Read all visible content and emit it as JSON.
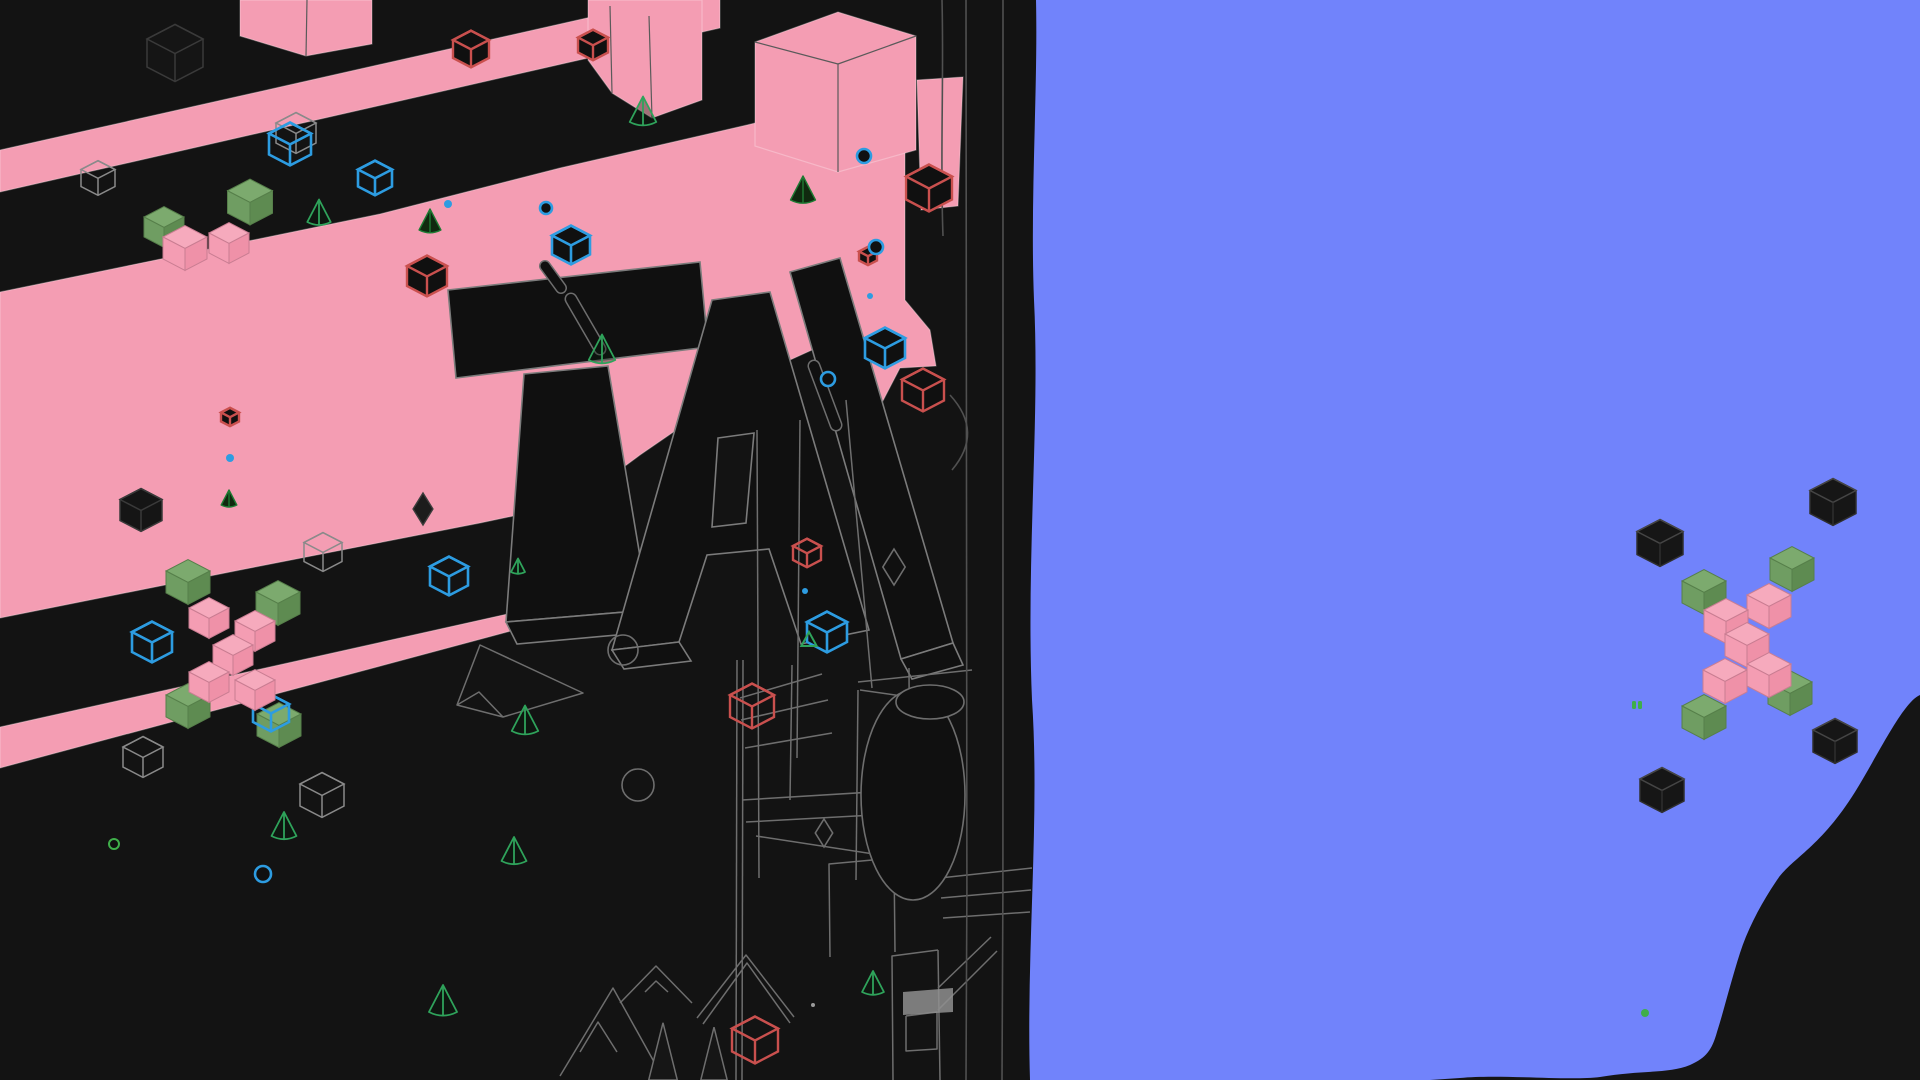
{
  "app": {
    "name": "stylized-3d-game-scene",
    "view": "isometric world viewport"
  },
  "palette": {
    "scene_black": "#131313",
    "column_line": "#505050",
    "blue_field": "#7183FB",
    "blob_black": "#151515",
    "pink": "#F49DB3",
    "pink_top": "#F6AABD",
    "pink_side": "#EF91A8",
    "pink_edge": "#C97D92",
    "pink_hi": "#F9C2D0",
    "green": "#6F9D62",
    "green_top": "#7CAA6E",
    "green_side": "#5E8B51",
    "green_edge": "#567F4A",
    "blue_wire": "#2D9CE1",
    "red_wire": "#C9504E",
    "gray_wire": "#6E6E6E",
    "faint_wire": "#3A3A3A",
    "cone_green": "#2FA35B",
    "cone_dark_fill": "#10290F",
    "cone_dark_edge": "#1E7A33",
    "letter_fill": "#101010",
    "letter_stroke": "#7B7B7B",
    "dark_fill": "#101010",
    "black_cube_fill": "#161616",
    "black_cube_edge": "#2F2F2F",
    "black_cube_top_edge": "#454545",
    "machine_gray": "#8F8F8F",
    "bright_green": "#3FAE4A",
    "gray_dot": "#9A9A9A"
  },
  "scene": {
    "width": 1920,
    "height": 1080,
    "blue_path": "M1036,0 L1920,0 L1920,1080 L1030,1080 C1026,950 1040,820 1032,700 C1026,560 1040,420 1034,300 C1030,200 1038,90 1036,0 Z",
    "blob_path": "M1920,695 C1903,702 1878,755 1855,792 C1820,848 1792,858 1777,880 C1762,902 1748,928 1740,953 C1731,981 1724,1010 1717,1032 C1712,1050 1706,1058 1690,1065 C1668,1074 1640,1070 1600,1077 C1568,1081 1500,1074 1460,1078 L1430,1080 L1920,1080 Z",
    "pink_polygons": [
      {
        "name": "diagonal-band-top",
        "points": "0,150 0,192 720,28 720,-12"
      },
      {
        "name": "top-left-pink-cube",
        "points": "240,0 372,0 372,44 306,56 240,36"
      },
      {
        "name": "main-pink-field",
        "points": "0,292 380,214 560,168 747,125 905,87 905,300 930,330 936,366 900,368 873,420 850,393 823,345 790,360 720,400 640,455 575,503 480,523 240,570 0,618"
      },
      {
        "name": "pink-strip-island",
        "points": "917,80 963,77 958,206 921,210"
      },
      {
        "name": "thin-pink-road",
        "points": "0,727 0,768 552,620 557,603"
      },
      {
        "name": "platform-pink-cube",
        "points": "588,0 702,0 702,100 652,118 612,93 588,60"
      },
      {
        "name": "hero-pink-cube",
        "points": "755,42 838,12 916,36 916,150 838,172 755,146"
      }
    ],
    "pink_edge_lines": [
      "306,56 307,0",
      "612,93 610,6",
      "652,118 649,16",
      "755,42 838,64",
      "838,64 916,36",
      "838,64 838,172"
    ],
    "letter_paths": [
      {
        "name": "letter-T-bar",
        "d": "M448,290 L700,262 L708,347 L456,378 Z"
      },
      {
        "name": "letter-T-stem",
        "d": "M524,374 L608,366 L649,610 L506,622 Z"
      },
      {
        "name": "letter-T-bottom-face",
        "d": "M506,622 L649,610 L661,631 L517,644 Z"
      },
      {
        "name": "letter-A-body",
        "d": "M712,300 L770,292 L869,630 L801,644 L769,549 L707,555 L679,642 L612,650 Z M718,438 L754,433 L746,523 L712,527 Z"
      },
      {
        "name": "letter-A-bottom-face",
        "d": "M612,650 L679,642 L691,661 L624,669 Z"
      },
      {
        "name": "letter-N-stroke",
        "d": "M790,272 L840,258 L953,643 L901,659 Z"
      },
      {
        "name": "letter-N-bottom-face",
        "d": "M901,659 L953,643 L963,665 L912,679 Z"
      }
    ],
    "wire_polylines": [
      "457,705 480,645 583,693 503,717 457,705 479,692 503,717",
      "560,1076 613,988 663,1078",
      "580,1052 598,1022 617,1052",
      "620,1003 656,966 692,1003",
      "645,992 656,981 668,992",
      "697,1018 746,955 794,1017",
      "703,1024 747,963 790,1023",
      "830,957 829,864 894,858 895,952",
      "938,950 892,956 893,1080",
      "938,950 940,1080",
      "906,1016 937,1012 937,1049 906,1051 906,1016",
      "940,878 1032,868",
      "941,898 1031,890",
      "943,918 1030,912",
      "938,988 991,937",
      "938,1010 997,951",
      "742,800 938,788",
      "746,822 930,812",
      "756,836 900,858",
      "740,698 822,674",
      "741,720 828,700",
      "745,748 832,733",
      "858,682 972,670",
      "860,690 930,700",
      "737,660 736,1080",
      "743,660 742,1080",
      "792,665 790,800",
      "858,690 856,880",
      "757,430 759,878",
      "800,420 797,758",
      "846,400 872,688",
      "909,668 910,880"
    ],
    "wire_paths": [
      "M942,0 C944,80 940,160 943,236",
      "M966,0 C964,300 969,700 966,1080",
      "M1003,0 C1000,300 1005,700 1002,1080",
      "M950,395 Q984,432 952,470"
    ],
    "wire_circles": [
      {
        "cx": 623,
        "cy": 650,
        "r": 15
      },
      {
        "cx": 638,
        "cy": 785,
        "r": 16
      }
    ],
    "wire_ellipses": [
      {
        "cx": 913,
        "cy": 795,
        "rx": 52,
        "ry": 105
      },
      {
        "cx": 930,
        "cy": 702,
        "rx": 34,
        "ry": 17
      }
    ],
    "machine_quad": "903,992 953,988 953,1012 903,1015",
    "capsules": [
      {
        "x1": 545,
        "y1": 266,
        "x2": 561,
        "y2": 288,
        "w": 9
      },
      {
        "x1": 571,
        "y1": 299,
        "x2": 600,
        "y2": 349,
        "w": 10
      },
      {
        "x1": 814,
        "y1": 366,
        "x2": 836,
        "y2": 425,
        "w": 10
      }
    ],
    "objects": [
      {
        "type": "faintWireCube",
        "x": 175,
        "y": 53,
        "s": 56
      },
      {
        "type": "grayWireCube",
        "x": 98,
        "y": 178,
        "s": 34
      },
      {
        "type": "grayWireCube",
        "x": 296,
        "y": 133,
        "s": 40
      },
      {
        "type": "blueWireCube",
        "x": 290,
        "y": 144,
        "s": 42
      },
      {
        "type": "blueWireCube",
        "x": 375,
        "y": 178,
        "s": 34
      },
      {
        "type": "greenCube",
        "x": 250,
        "y": 202,
        "s": 45
      },
      {
        "type": "greenCube",
        "x": 164,
        "y": 227,
        "s": 40
      },
      {
        "type": "pinkCube",
        "x": 229,
        "y": 243,
        "s": 40
      },
      {
        "type": "pinkCube",
        "x": 185,
        "y": 248,
        "s": 44
      },
      {
        "type": "coneWire",
        "x": 319,
        "y": 222,
        "s": 15
      },
      {
        "type": "redWireCubeDark",
        "x": 471,
        "y": 49,
        "s": 36
      },
      {
        "type": "redWireCubeDark",
        "x": 593,
        "y": 45,
        "s": 30
      },
      {
        "type": "coneWire",
        "x": 643,
        "y": 122,
        "s": 17
      },
      {
        "type": "dotBlue",
        "x": 448,
        "y": 204,
        "s": 4
      },
      {
        "type": "ringBlue",
        "x": 546,
        "y": 208,
        "s": 6
      },
      {
        "type": "coneDark",
        "x": 430,
        "y": 230,
        "s": 14
      },
      {
        "type": "coneDark",
        "x": 803,
        "y": 200,
        "s": 16
      },
      {
        "type": "ringBlue",
        "x": 864,
        "y": 156,
        "s": 7
      },
      {
        "type": "blueWireCubeDark",
        "x": 571,
        "y": 245,
        "s": 38
      },
      {
        "type": "redWireCubeDark",
        "x": 427,
        "y": 276,
        "s": 40
      },
      {
        "type": "coneWire",
        "x": 602,
        "y": 360,
        "s": 17
      },
      {
        "type": "redWireCubeDark",
        "x": 929,
        "y": 188,
        "s": 46
      },
      {
        "type": "redWireCubeDark",
        "x": 868,
        "y": 256,
        "s": 18
      },
      {
        "type": "ringBlue",
        "x": 876,
        "y": 247,
        "s": 7
      },
      {
        "type": "dotBlue",
        "x": 870,
        "y": 296,
        "s": 3
      },
      {
        "type": "blueWireCubeDark",
        "x": 885,
        "y": 348,
        "s": 40
      },
      {
        "type": "redWireCubeDark",
        "x": 923,
        "y": 390,
        "s": 42
      },
      {
        "type": "ringBlue",
        "x": 828,
        "y": 379,
        "s": 7
      },
      {
        "type": "redWireCubeDark",
        "x": 230,
        "y": 417,
        "s": 18
      },
      {
        "type": "dotBlue",
        "x": 230,
        "y": 458,
        "s": 4
      },
      {
        "type": "coneDark",
        "x": 229,
        "y": 505,
        "s": 10
      },
      {
        "type": "faintWireCube",
        "x": 141,
        "y": 510,
        "s": 42
      },
      {
        "type": "diamondDark",
        "x": 423,
        "y": 509,
        "s": 16
      },
      {
        "type": "grayWireCube",
        "x": 323,
        "y": 552,
        "s": 38
      },
      {
        "type": "blueWireCube",
        "x": 449,
        "y": 576,
        "s": 38
      },
      {
        "type": "blueWireCube",
        "x": 152,
        "y": 642,
        "s": 40
      },
      {
        "type": "greenCube",
        "x": 188,
        "y": 582,
        "s": 44
      },
      {
        "type": "greenCube",
        "x": 278,
        "y": 603,
        "s": 44
      },
      {
        "type": "greenCube",
        "x": 188,
        "y": 706,
        "s": 44
      },
      {
        "type": "greenCube",
        "x": 279,
        "y": 725,
        "s": 44
      },
      {
        "type": "blueWireCube",
        "x": 271,
        "y": 713,
        "s": 36
      },
      {
        "type": "pinkCube",
        "x": 209,
        "y": 618,
        "s": 40
      },
      {
        "type": "pinkCube",
        "x": 255,
        "y": 631,
        "s": 40
      },
      {
        "type": "pinkCube",
        "x": 233,
        "y": 655,
        "s": 40
      },
      {
        "type": "pinkCube",
        "x": 209,
        "y": 682,
        "s": 40
      },
      {
        "type": "pinkCube",
        "x": 255,
        "y": 690,
        "s": 40
      },
      {
        "type": "grayWireCube",
        "x": 143,
        "y": 757,
        "s": 40
      },
      {
        "type": "grayWireCube",
        "x": 322,
        "y": 795,
        "s": 44
      },
      {
        "type": "coneWire",
        "x": 284,
        "y": 836,
        "s": 16
      },
      {
        "type": "ringGreen",
        "x": 114,
        "y": 844,
        "s": 5
      },
      {
        "type": "ringBlue",
        "x": 263,
        "y": 874,
        "s": 8
      },
      {
        "type": "coneWire",
        "x": 443,
        "y": 1012,
        "s": 18
      },
      {
        "type": "coneWire",
        "x": 518,
        "y": 572,
        "s": 9
      },
      {
        "type": "coneWire",
        "x": 525,
        "y": 731,
        "s": 17
      },
      {
        "type": "coneWire",
        "x": 514,
        "y": 861,
        "s": 16
      },
      {
        "type": "redWireCube",
        "x": 807,
        "y": 553,
        "s": 28
      },
      {
        "type": "dotBlue",
        "x": 805,
        "y": 591,
        "s": 3
      },
      {
        "type": "blueWireCubeDark",
        "x": 827,
        "y": 632,
        "s": 40
      },
      {
        "type": "triGreen",
        "x": 809,
        "y": 646,
        "s": 14
      },
      {
        "type": "diamondGray",
        "x": 894,
        "y": 567,
        "s": 18
      },
      {
        "type": "diamondGray",
        "x": 824,
        "y": 833,
        "s": 14
      },
      {
        "type": "redWireCube",
        "x": 752,
        "y": 706,
        "s": 44
      },
      {
        "type": "spike",
        "x": 663,
        "y": 1080,
        "s": 26
      },
      {
        "type": "spike",
        "x": 714,
        "y": 1080,
        "s": 24
      },
      {
        "type": "coneWire",
        "x": 873,
        "y": 992,
        "s": 14
      },
      {
        "type": "dotGray",
        "x": 813,
        "y": 1005,
        "s": 2
      },
      {
        "type": "redWireCube",
        "x": 755,
        "y": 1040,
        "s": 46
      },
      {
        "type": "blackCube",
        "x": 1660,
        "y": 543,
        "s": 46
      },
      {
        "type": "blackCube",
        "x": 1833,
        "y": 502,
        "s": 46
      },
      {
        "type": "blackCube",
        "x": 1835,
        "y": 741,
        "s": 44
      },
      {
        "type": "blackCube",
        "x": 1662,
        "y": 790,
        "s": 44
      },
      {
        "type": "greenCube",
        "x": 1704,
        "y": 592,
        "s": 44
      },
      {
        "type": "greenCube",
        "x": 1792,
        "y": 569,
        "s": 44
      },
      {
        "type": "greenCube",
        "x": 1790,
        "y": 693,
        "s": 44
      },
      {
        "type": "greenCube",
        "x": 1704,
        "y": 717,
        "s": 44
      },
      {
        "type": "pinkCube",
        "x": 1769,
        "y": 606,
        "s": 44
      },
      {
        "type": "pinkCube",
        "x": 1726,
        "y": 621,
        "s": 44
      },
      {
        "type": "pinkCube",
        "x": 1747,
        "y": 645,
        "s": 44
      },
      {
        "type": "pinkCube",
        "x": 1725,
        "y": 681,
        "s": 44
      },
      {
        "type": "pinkCube",
        "x": 1769,
        "y": 675,
        "s": 44
      },
      {
        "type": "greenPair",
        "x": 1637,
        "y": 705,
        "s": 4
      },
      {
        "type": "dotGreen",
        "x": 1645,
        "y": 1013,
        "s": 4
      }
    ]
  }
}
